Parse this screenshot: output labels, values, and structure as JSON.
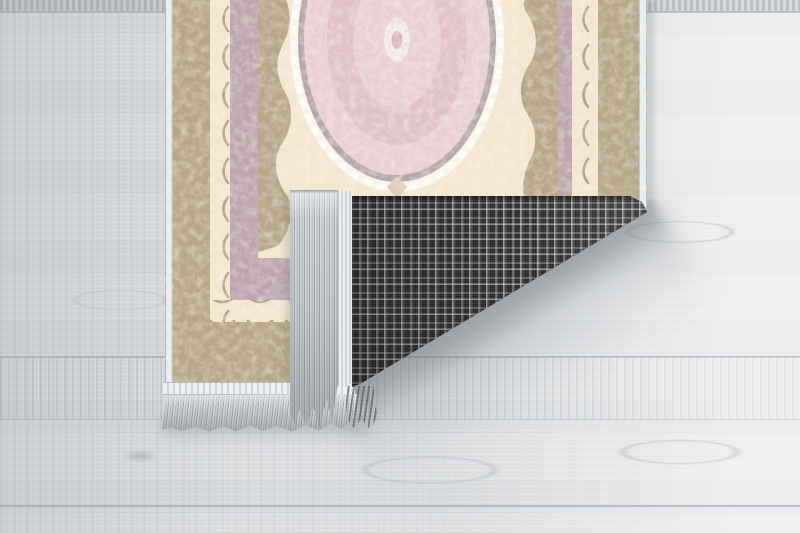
{
  "meta": {
    "description": "Product photograph of an oriental-style runner rug lying on a light gray wooden plank floor; the bottom-right corner of the rug is folded over, revealing a dark gray tartan-check woven backing and light gray tassel fringe. No text appears in the image.",
    "image_type": "product-photo",
    "width_px": 800,
    "height_px": 533
  },
  "scene": {
    "floor": {
      "material": "whitewashed light gray wood planks",
      "plank_direction": "horizontal",
      "seam_positions_y": [
        11,
        356,
        419,
        505
      ]
    },
    "rug": {
      "style": "oriental medallion runner, cream / beige / powder pink",
      "medallion": "large ornate pink oval medallion with white scalloped surround and gray-mauve scrollwork",
      "borders_outer_to_inner": [
        "white edge binding",
        "beige dense scrollwork border",
        "cream stripe with crescent motifs",
        "mauve ornate band",
        "beige inner band with scalloped edge"
      ],
      "bounds": {
        "left": 165,
        "top": 0,
        "right": 647,
        "bottom": 390
      }
    },
    "fold": {
      "description": "bottom-right corner folded up over the rug face",
      "backing_pattern": "dark charcoal tartan check (plaid) with white and gray pinstripes",
      "folded_edge_fringe": "light gray tassel fringe and white woven binding on the folded edge"
    },
    "fringe_bottom": "light gray tassel fringe along the rug's bottom edge",
    "shadow": "soft diagonal shadow cast on the floor under the lifted folded corner"
  },
  "colors": {
    "floor-base": "#dfe1e3",
    "floor-light": "#eef0f1",
    "floor-dark": "#c9ccd0",
    "plank-seam": "#969ba0",
    "rug-cream": "#f4e6d0",
    "rug-beige": "#b7a78a",
    "rug-beige-dark": "#8d7f68",
    "rug-mauve": "#bca6ad",
    "medallion-pink": "#ecd1d5",
    "medallion-pink-deep": "#e2c0c7",
    "medallion-ring": "#b2a4a6",
    "medallion-white": "#faf5ec",
    "binding-white": "#eaedef",
    "plaid-base": "#3f3f3f",
    "plaid-light": "#9b9b9b",
    "plaid-white": "#d2d2d2",
    "fringe-light": "#d8dcde",
    "fringe-mid": "#b4babe",
    "fringe-dark": "#a2a9ad",
    "shadow": "#5f646a"
  }
}
